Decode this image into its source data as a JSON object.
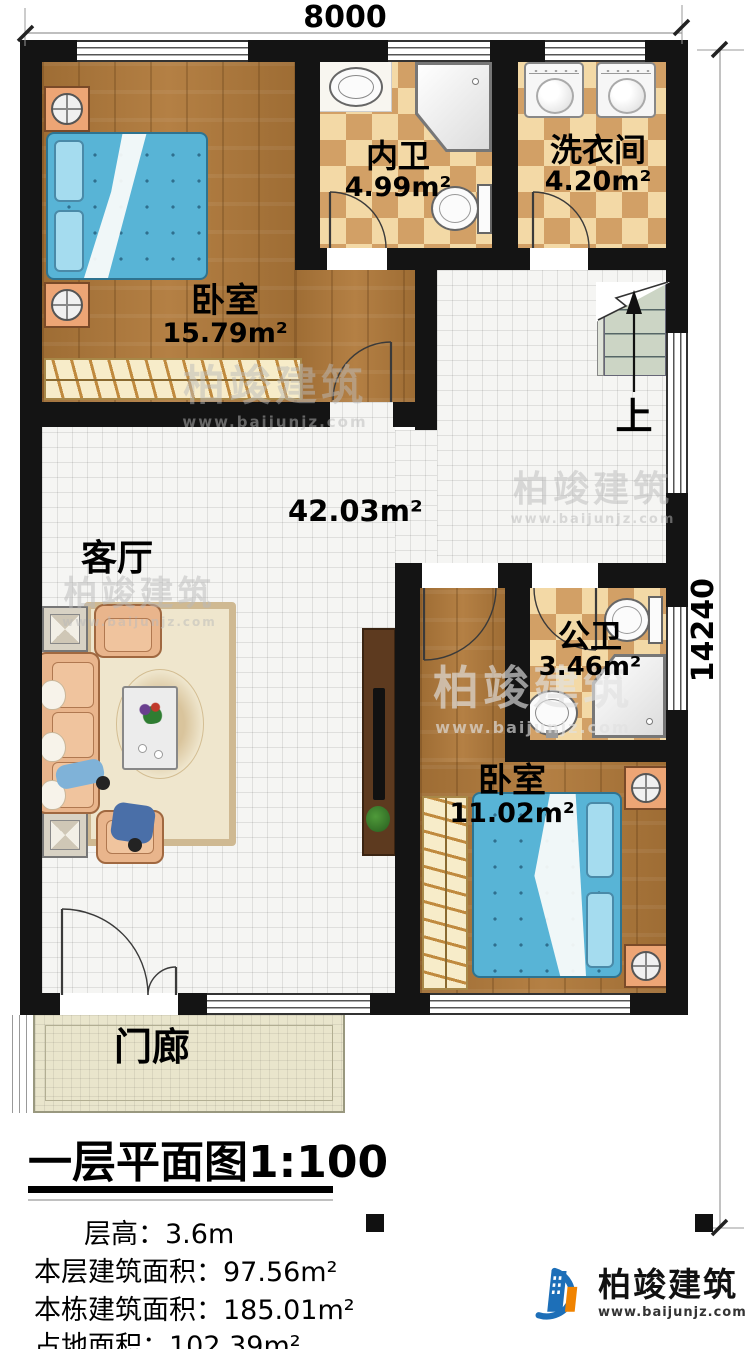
{
  "dimensions": {
    "top": "8000",
    "right": "14240"
  },
  "rooms": [
    {
      "id": "bedroom1",
      "name": "卧室",
      "area": "15.79m²"
    },
    {
      "id": "ensuite-bath",
      "name": "内卫",
      "area": "4.99m²"
    },
    {
      "id": "laundry",
      "name": "洗衣间",
      "area": "4.20m²"
    },
    {
      "id": "living-room",
      "name": "客厅",
      "area": "42.03m²"
    },
    {
      "id": "public-bath",
      "name": "公卫",
      "area": "3.46m²"
    },
    {
      "id": "bedroom2",
      "name": "卧室",
      "area": "11.02m²"
    },
    {
      "id": "porch",
      "name": "门廊",
      "area": ""
    }
  ],
  "stairs": {
    "up_label": "上"
  },
  "title": {
    "main": "一层平面图",
    "scale": "1:100"
  },
  "info": [
    {
      "label": "层高：",
      "value": "3.6m"
    },
    {
      "label": "本层建筑面积：",
      "value": "97.56m²"
    },
    {
      "label": "本栋建筑面积：",
      "value": "185.01m²"
    },
    {
      "label": "占地面积：",
      "value": "102.39m²"
    }
  ],
  "brand": {
    "name": "柏竣建筑",
    "url": "www.baijunjz.com"
  },
  "colors": {
    "wall": "#141414",
    "wood_floor": "#b0793a",
    "tile_check_light": "#f3d9a6",
    "tile_check_dark": "#d2a066",
    "bed_blue": "#58b4d6",
    "porch_tile": "#e9e5cc",
    "logo_blue": "#1d6fb8",
    "logo_orange": "#f08300"
  }
}
